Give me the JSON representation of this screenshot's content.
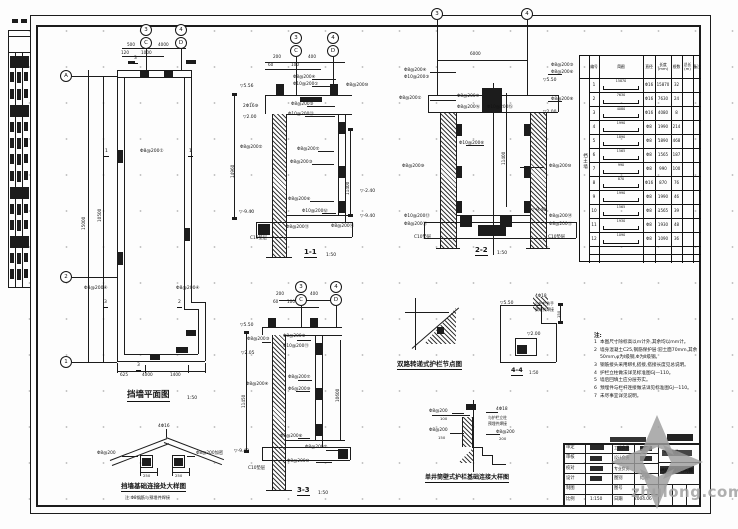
{
  "watermark": {
    "text": "zhulong.com"
  },
  "notes": {
    "header": "注:",
    "items": [
      "本图尺寸除标高以m计外,其余均以mm计。",
      "墙身混凝土C25,钢筋保护层:迎土面70mm,其余50mm,φ为Ⅰ级钢,Φ为Ⅱ级钢。",
      "钢筋接头采用绑扎搭接,搭接长度见总说明。",
      "护栏立柱做法详见标准图GJ—110。",
      "墙后回填土应分层夯实。",
      "预埋件与栏杆连接做法详见标准图GJ—110。",
      "未尽事宜详见说明。"
    ]
  },
  "table": {
    "side_label": "挡土墙",
    "headers": [
      "编号",
      "简图",
      "直径",
      "长度(mm)",
      "根数",
      "总长(m)",
      "备注"
    ],
    "rows": [
      {
        "no": "1",
        "sk": "15870",
        "dia": "Φ16",
        "len": "15870",
        "cnt": "32",
        "tot": ""
      },
      {
        "no": "2",
        "sk": "7630",
        "dia": "Φ16",
        "len": "7630",
        "cnt": "24",
        "tot": ""
      },
      {
        "no": "3",
        "sk": "4080",
        "dia": "Φ16",
        "len": "4080",
        "cnt": "8",
        "tot": ""
      },
      {
        "no": "4",
        "sk": "1990",
        "dia": "Φ8",
        "len": "1990",
        "cnt": "214",
        "tot": ""
      },
      {
        "no": "5",
        "sk": "1890",
        "dia": "Φ8",
        "len": "1890",
        "cnt": "468",
        "tot": ""
      },
      {
        "no": "6",
        "sk": "1565",
        "dia": "Φ8",
        "len": "1565",
        "cnt": "187",
        "tot": ""
      },
      {
        "no": "7",
        "sk": "990",
        "dia": "Φ8",
        "len": "990",
        "cnt": "100",
        "tot": ""
      },
      {
        "no": "8",
        "sk": "870",
        "dia": "Φ16",
        "len": "870",
        "cnt": "76",
        "tot": ""
      },
      {
        "no": "9",
        "sk": "1990",
        "dia": "Φ8",
        "len": "1990",
        "cnt": "46",
        "tot": ""
      },
      {
        "no": "10",
        "sk": "1565",
        "dia": "Φ8",
        "len": "1565",
        "cnt": "39",
        "tot": ""
      },
      {
        "no": "11",
        "sk": "1930",
        "dia": "Φ8",
        "len": "1930",
        "cnt": "48",
        "tot": ""
      },
      {
        "no": "12",
        "sk": "1090",
        "dia": "Φ8",
        "len": "1090",
        "cnt": "36",
        "tot": ""
      }
    ]
  },
  "bubbles": [
    {
      "t": "3",
      "x": 146,
      "y": 30
    },
    {
      "t": "C",
      "x": 146,
      "y": 43
    },
    {
      "t": "4",
      "x": 181,
      "y": 30
    },
    {
      "t": "D",
      "x": 181,
      "y": 43
    },
    {
      "t": "A",
      "x": 66,
      "y": 76
    },
    {
      "t": "2",
      "x": 66,
      "y": 277
    },
    {
      "t": "1",
      "x": 66,
      "y": 362
    },
    {
      "t": "3",
      "x": 296,
      "y": 38
    },
    {
      "t": "C",
      "x": 296,
      "y": 51
    },
    {
      "t": "4",
      "x": 333,
      "y": 38
    },
    {
      "t": "D",
      "x": 333,
      "y": 51
    },
    {
      "t": "3",
      "x": 437,
      "y": 14
    },
    {
      "t": "4",
      "x": 527,
      "y": 14
    },
    {
      "t": "3",
      "x": 301,
      "y": 287
    },
    {
      "t": "C",
      "x": 301,
      "y": 300
    },
    {
      "t": "4",
      "x": 336,
      "y": 287
    },
    {
      "t": "D",
      "x": 336,
      "y": 300
    }
  ],
  "annotations": [
    {
      "t": "500",
      "x": 127,
      "y": 43,
      "fs": 4.2
    },
    {
      "t": "4000",
      "x": 158,
      "y": 43,
      "fs": 4.2
    },
    {
      "t": "120",
      "x": 121,
      "y": 51,
      "fs": 4.2
    },
    {
      "t": "1000",
      "x": 141,
      "y": 51,
      "fs": 4.2
    },
    {
      "t": "15000",
      "x": 82,
      "y": 230,
      "rot": 1,
      "fs": 4.2
    },
    {
      "t": "10500",
      "x": 98,
      "y": 222,
      "rot": 1,
      "fs": 4.2
    },
    {
      "t": "14960",
      "x": 231,
      "y": 178,
      "rot": 1,
      "fs": 4.2
    },
    {
      "t": "Φ8@200①",
      "x": 140,
      "y": 150,
      "fs": 4.5
    },
    {
      "t": "Φ8@200④",
      "x": 84,
      "y": 287,
      "fs": 4.5
    },
    {
      "t": "Φ8@200④",
      "x": 176,
      "y": 287,
      "fs": 4.5
    },
    {
      "t": "625",
      "x": 120,
      "y": 373,
      "fs": 4.2
    },
    {
      "t": "4000",
      "x": 142,
      "y": 373,
      "fs": 4.2
    },
    {
      "t": "1400",
      "x": 170,
      "y": 373,
      "fs": 4.2
    },
    {
      "t": "1",
      "x": 104,
      "y": 150,
      "cut": 1
    },
    {
      "t": "1",
      "x": 188,
      "y": 150,
      "cut": 1
    },
    {
      "t": "3",
      "x": 103,
      "y": 301,
      "cut": 1
    },
    {
      "t": "2",
      "x": 177,
      "y": 301,
      "cut": 1
    },
    {
      "t": "3",
      "x": 133,
      "y": 57,
      "cut": 1
    },
    {
      "t": "3",
      "x": 136,
      "y": 364,
      "cut": 1
    },
    {
      "t": "挡墙平面图",
      "x": 127,
      "y": 391,
      "fs": 8.5,
      "b": 1,
      "u": 1,
      "nm": "plan-title"
    },
    {
      "t": "1:50",
      "x": 187,
      "y": 397,
      "fs": 4.5,
      "nm": "plan-scale"
    },
    {
      "t": "200",
      "x": 273,
      "y": 55,
      "fs": 4.2
    },
    {
      "t": "400",
      "x": 308,
      "y": 55,
      "fs": 4.2
    },
    {
      "t": "60",
      "x": 268,
      "y": 63,
      "fs": 4.2
    },
    {
      "t": "100",
      "x": 291,
      "y": 63,
      "fs": 4.2
    },
    {
      "t": "▽5.56",
      "x": 240,
      "y": 85,
      "fs": 4.5,
      "nm": "elevation-marker"
    },
    {
      "t": "▽2.00",
      "x": 243,
      "y": 116,
      "fs": 4.5,
      "nm": "elevation-marker"
    },
    {
      "t": "▽-2.40",
      "x": 360,
      "y": 190,
      "fs": 4.5,
      "nm": "elevation-marker"
    },
    {
      "t": "▽-9.40",
      "x": 239,
      "y": 211,
      "fs": 4.5,
      "nm": "elevation-marker"
    },
    {
      "t": "▽-9.40",
      "x": 360,
      "y": 215,
      "fs": 4.5,
      "nm": "elevation-marker"
    },
    {
      "t": "Φ8@200④",
      "x": 293,
      "y": 76,
      "fs": 4.3
    },
    {
      "t": "Φ10@200①",
      "x": 293,
      "y": 83,
      "fs": 4.3
    },
    {
      "t": "Φ8@200⑩",
      "x": 346,
      "y": 84,
      "fs": 4.3
    },
    {
      "t": "2Φ16⑨",
      "x": 243,
      "y": 105,
      "fs": 4.3
    },
    {
      "t": "Φ8@200⑤",
      "x": 291,
      "y": 103,
      "fs": 4.3
    },
    {
      "t": "Φ10@200⑪",
      "x": 288,
      "y": 113,
      "fs": 4.3
    },
    {
      "t": "Φ8@200②",
      "x": 240,
      "y": 146,
      "fs": 4.3
    },
    {
      "t": "Φ8@200⑦",
      "x": 297,
      "y": 148,
      "fs": 4.3
    },
    {
      "t": "Φ8@200③",
      "x": 290,
      "y": 161,
      "fs": 4.3
    },
    {
      "t": "Φ8@200⑥",
      "x": 288,
      "y": 198,
      "fs": 4.3
    },
    {
      "t": "Φ10@200⑫",
      "x": 302,
      "y": 210,
      "fs": 4.3
    },
    {
      "t": "Φ8@200⑬",
      "x": 286,
      "y": 226,
      "fs": 4.3
    },
    {
      "t": "Φ8@200⑭",
      "x": 331,
      "y": 225,
      "fs": 4.3
    },
    {
      "t": "C10垫层",
      "x": 250,
      "y": 237,
      "fs": 4.3
    },
    {
      "t": "11400",
      "x": 346,
      "y": 195,
      "rot": 1,
      "fs": 4.2
    },
    {
      "t": "1-1",
      "x": 304,
      "y": 249,
      "fs": 7,
      "b": 1,
      "u": 1,
      "nm": "section-1-1-caption"
    },
    {
      "t": "1:50",
      "x": 326,
      "y": 254,
      "fs": 4.5
    },
    {
      "t": "6000",
      "x": 470,
      "y": 52,
      "fs": 4.2
    },
    {
      "t": "▽5.50",
      "x": 543,
      "y": 79,
      "fs": 4.5,
      "nm": "elevation-marker"
    },
    {
      "t": "▽2.00",
      "x": 543,
      "y": 111,
      "fs": 4.5,
      "nm": "elevation-marker"
    },
    {
      "t": "▽-9.40",
      "x": 531,
      "y": 209,
      "fs": 4.5,
      "nm": "elevation-marker"
    },
    {
      "t": "Φ8@200④",
      "x": 404,
      "y": 69,
      "fs": 4.3
    },
    {
      "t": "Φ10@200③",
      "x": 404,
      "y": 76,
      "fs": 4.3
    },
    {
      "t": "Φ8@200①",
      "x": 399,
      "y": 97,
      "fs": 4.3
    },
    {
      "t": "Φ8@200⑨",
      "x": 402,
      "y": 165,
      "fs": 4.3
    },
    {
      "t": "Φ10@200⑬",
      "x": 404,
      "y": 215,
      "fs": 4.3
    },
    {
      "t": "Φ8@200⑪",
      "x": 404,
      "y": 223,
      "fs": 4.3
    },
    {
      "t": "Φ8@200⑤",
      "x": 551,
      "y": 64,
      "fs": 4.3
    },
    {
      "t": "Φ8@200⑥",
      "x": 551,
      "y": 71,
      "fs": 4.3
    },
    {
      "t": "Φ8@200⑧",
      "x": 551,
      "y": 98,
      "fs": 4.3
    },
    {
      "t": "Φ8@200⑩",
      "x": 549,
      "y": 165,
      "fs": 4.3
    },
    {
      "t": "Φ8@200⑭",
      "x": 549,
      "y": 215,
      "fs": 4.3
    },
    {
      "t": "Φ8@200⑫",
      "x": 549,
      "y": 223,
      "fs": 4.3
    },
    {
      "t": "Φ8@200⑦",
      "x": 457,
      "y": 95,
      "fs": 4.3
    },
    {
      "t": "Φ8@200⑯",
      "x": 457,
      "y": 106,
      "fs": 4.3
    },
    {
      "t": "Φ10@200⑮",
      "x": 487,
      "y": 106,
      "fs": 4.3
    },
    {
      "t": "Φ10@200⑧",
      "x": 459,
      "y": 142,
      "fs": 4.3
    },
    {
      "t": "C10垫层",
      "x": 414,
      "y": 236,
      "fs": 4.3
    },
    {
      "t": "C10垫层",
      "x": 548,
      "y": 236,
      "fs": 4.3
    },
    {
      "t": "11400",
      "x": 502,
      "y": 165,
      "rot": 1,
      "fs": 4.2
    },
    {
      "t": "2-2",
      "x": 475,
      "y": 247,
      "fs": 7,
      "b": 1,
      "u": 1,
      "nm": "section-2-2-caption"
    },
    {
      "t": "1:50",
      "x": 497,
      "y": 252,
      "fs": 4.5
    },
    {
      "t": "200",
      "x": 276,
      "y": 292,
      "fs": 4.2
    },
    {
      "t": "400",
      "x": 310,
      "y": 292,
      "fs": 4.2
    },
    {
      "t": "60",
      "x": 273,
      "y": 300,
      "fs": 4.2
    },
    {
      "t": "100",
      "x": 287,
      "y": 300,
      "fs": 4.2
    },
    {
      "t": "▽5.50",
      "x": 240,
      "y": 324,
      "fs": 4.5,
      "nm": "elevation-marker"
    },
    {
      "t": "▽2.05",
      "x": 241,
      "y": 352,
      "fs": 4.5,
      "nm": "elevation-marker"
    },
    {
      "t": "▽-9.40",
      "x": 234,
      "y": 450,
      "fs": 4.5,
      "nm": "elevation-marker"
    },
    {
      "t": "Φ8@200③",
      "x": 247,
      "y": 338,
      "fs": 4.3
    },
    {
      "t": "Φ8@200⑤",
      "x": 283,
      "y": 335,
      "fs": 4.3
    },
    {
      "t": "Φ10@200⑪",
      "x": 283,
      "y": 345,
      "fs": 4.3
    },
    {
      "t": "Φ8@200④",
      "x": 246,
      "y": 383,
      "fs": 4.3
    },
    {
      "t": "Φ8@200⑦",
      "x": 288,
      "y": 376,
      "fs": 4.3
    },
    {
      "t": "Φ6@200⑨",
      "x": 288,
      "y": 388,
      "fs": 4.3
    },
    {
      "t": "Φ8@200⑥",
      "x": 280,
      "y": 435,
      "fs": 4.3
    },
    {
      "t": "Φ8@200②",
      "x": 305,
      "y": 446,
      "fs": 4.3
    },
    {
      "t": "Φ8@200⑩",
      "x": 287,
      "y": 460,
      "fs": 4.3
    },
    {
      "t": "C10垫层",
      "x": 248,
      "y": 467,
      "fs": 4.3
    },
    {
      "t": "11450",
      "x": 242,
      "y": 408,
      "rot": 1,
      "fs": 4.2
    },
    {
      "t": "10600",
      "x": 336,
      "y": 402,
      "rot": 1,
      "fs": 4.2
    },
    {
      "t": "3-3",
      "x": 297,
      "y": 487,
      "fs": 7,
      "b": 1,
      "u": 1,
      "nm": "section-3-3-caption"
    },
    {
      "t": "1:50",
      "x": 318,
      "y": 492,
      "fs": 4.5
    },
    {
      "t": "双路转递式护栏节点图",
      "x": 397,
      "y": 361,
      "fs": 6.5,
      "b": 1,
      "u": 1,
      "nm": "detail-node-caption"
    },
    {
      "t": "4Φ18",
      "x": 535,
      "y": 295,
      "fs": 4.3
    },
    {
      "t": "与护栏扶手",
      "x": 535,
      "y": 302,
      "fs": 3.8
    },
    {
      "t": "预埋件焊接",
      "x": 535,
      "y": 308,
      "fs": 3.8
    },
    {
      "t": "▽5.50",
      "x": 500,
      "y": 302,
      "fs": 4.5,
      "nm": "elevation-marker"
    },
    {
      "t": "▽2.00",
      "x": 527,
      "y": 333,
      "fs": 4.5,
      "nm": "elevation-marker"
    },
    {
      "t": "150",
      "x": 557,
      "y": 318,
      "rot": 1,
      "fs": 3.8
    },
    {
      "t": "4-4",
      "x": 511,
      "y": 367,
      "fs": 6.5,
      "b": 1,
      "u": 1,
      "nm": "detail-4-4-caption"
    },
    {
      "t": "1:50",
      "x": 529,
      "y": 371,
      "fs": 4.2
    },
    {
      "t": "4Φ16",
      "x": 158,
      "y": 425,
      "fs": 4.3
    },
    {
      "t": "Φ8@200",
      "x": 97,
      "y": 452,
      "fs": 4.3
    },
    {
      "t": "Φ8@200加密",
      "x": 196,
      "y": 452,
      "fs": 4.3
    },
    {
      "t": "250",
      "x": 143,
      "y": 474,
      "fs": 3.8
    },
    {
      "t": "250",
      "x": 175,
      "y": 474,
      "fs": 3.8
    },
    {
      "t": "挡墙基础连接处大样图",
      "x": 121,
      "y": 483,
      "fs": 6.5,
      "b": 1,
      "u": 1,
      "nm": "detail-left-caption"
    },
    {
      "t": "注:Φ8钢筋与预埋件焊接",
      "x": 125,
      "y": 496,
      "fs": 4.2
    },
    {
      "t": "Φ8@200",
      "x": 429,
      "y": 410,
      "fs": 4.3
    },
    {
      "t": "100",
      "x": 440,
      "y": 417,
      "fs": 3.8
    },
    {
      "t": "Φ8@200",
      "x": 429,
      "y": 429,
      "fs": 4.3
    },
    {
      "t": "150",
      "x": 438,
      "y": 436,
      "fs": 3.8
    },
    {
      "t": "4Φ18",
      "x": 496,
      "y": 408,
      "fs": 4.3
    },
    {
      "t": "与护栏立柱",
      "x": 488,
      "y": 416,
      "fs": 3.8
    },
    {
      "t": "预埋件焊接",
      "x": 488,
      "y": 422,
      "fs": 3.8
    },
    {
      "t": "Φ8@200",
      "x": 496,
      "y": 431,
      "fs": 4.3
    },
    {
      "t": "200",
      "x": 499,
      "y": 437,
      "fs": 3.8
    },
    {
      "t": "单井筒壁式护栏基础连接大样图",
      "x": 425,
      "y": 475,
      "fs": 6,
      "b": 1,
      "u": 1,
      "nm": "detail-right-caption"
    },
    {
      "t": "审定",
      "x": 566,
      "y": 446,
      "fs": 4.3,
      "nm": "tb-label"
    },
    {
      "t": "审核",
      "x": 566,
      "y": 456,
      "fs": 4.3,
      "nm": "tb-label"
    },
    {
      "t": "校对",
      "x": 566,
      "y": 467,
      "fs": 4.3,
      "nm": "tb-label"
    },
    {
      "t": "设计",
      "x": 566,
      "y": 477,
      "fs": 4.3,
      "nm": "tb-label"
    },
    {
      "t": "制图",
      "x": 566,
      "y": 487,
      "fs": 4.3,
      "nm": "tb-label"
    },
    {
      "t": "比例",
      "x": 566,
      "y": 498,
      "fs": 4.3,
      "nm": "tb-label"
    },
    {
      "t": "工程负责",
      "x": 614,
      "y": 446,
      "fs": 3.9,
      "nm": "tb-label"
    },
    {
      "t": "设计负责",
      "x": 614,
      "y": 456,
      "fs": 3.9,
      "nm": "tb-label"
    },
    {
      "t": "专业负责",
      "x": 614,
      "y": 467,
      "fs": 3.9,
      "nm": "tb-label"
    },
    {
      "t": "图别",
      "x": 614,
      "y": 477,
      "fs": 4.3,
      "nm": "tb-label"
    },
    {
      "t": "图号",
      "x": 614,
      "y": 487,
      "fs": 4.3,
      "nm": "tb-label"
    },
    {
      "t": "日期",
      "x": 614,
      "y": 498,
      "fs": 4.3,
      "nm": "tb-label"
    },
    {
      "t": "结施",
      "x": 640,
      "y": 477,
      "fs": 4.3,
      "nm": "tb-sheet-type"
    },
    {
      "t": "1:150",
      "x": 590,
      "y": 498,
      "fs": 4.3,
      "nm": "tb-scale"
    },
    {
      "t": "2004.06",
      "x": 634,
      "y": 498,
      "fs": 4.3,
      "nm": "tb-date"
    },
    {
      "t": "××工程",
      "x": 663,
      "y": 450,
      "fs": 4.2,
      "nm": "tb-project"
    },
    {
      "t": "挡墙护栏结构图",
      "x": 660,
      "y": 470,
      "fs": 4.8,
      "b": 1,
      "nm": "tb-drawing-title"
    }
  ]
}
